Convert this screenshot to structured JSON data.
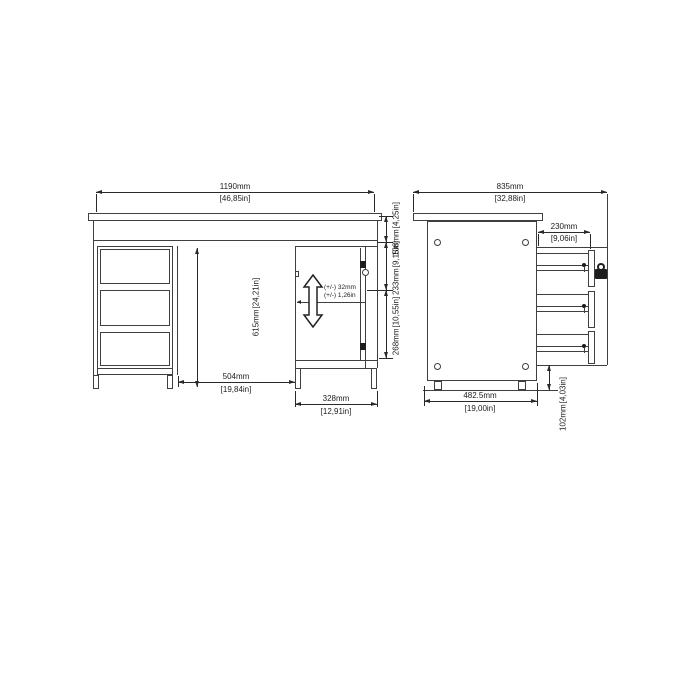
{
  "page": {
    "background": "#ffffff",
    "line_color": "#3f3f3f",
    "description": "Technical dimension drawing of a desk: front view (left) and side view (right)"
  },
  "dims": {
    "front_width": {
      "mm": "1190mm",
      "inch": "[46,85in]"
    },
    "front_top_height": {
      "mm": "108mm",
      "inch": "[4,25in]"
    },
    "front_upper_right": {
      "mm": "233mm",
      "inch": "[9,15in]"
    },
    "front_lower_right": {
      "mm": "268mm",
      "inch": "[10,55in]"
    },
    "front_interior_height": {
      "mm": "615mm",
      "inch": "[24,21in]"
    },
    "front_knee_width": {
      "mm": "504mm",
      "inch": "[19,84in]"
    },
    "front_cabinet_width": {
      "mm": "328mm",
      "inch": "[12,91in]"
    },
    "shelf_adjust": {
      "line1": "(+/-) 32mm",
      "line2": "(+/-) 1,26in"
    },
    "side_depth": {
      "mm": "835mm",
      "inch": "[32,88in]"
    },
    "side_drawer_depth": {
      "mm": "230mm",
      "inch": "[9,06in]"
    },
    "side_base_depth": {
      "mm": "482.5mm",
      "inch": "[19,00in]"
    },
    "side_base_height": {
      "mm": "102mm",
      "inch": "[4,03in]"
    }
  }
}
